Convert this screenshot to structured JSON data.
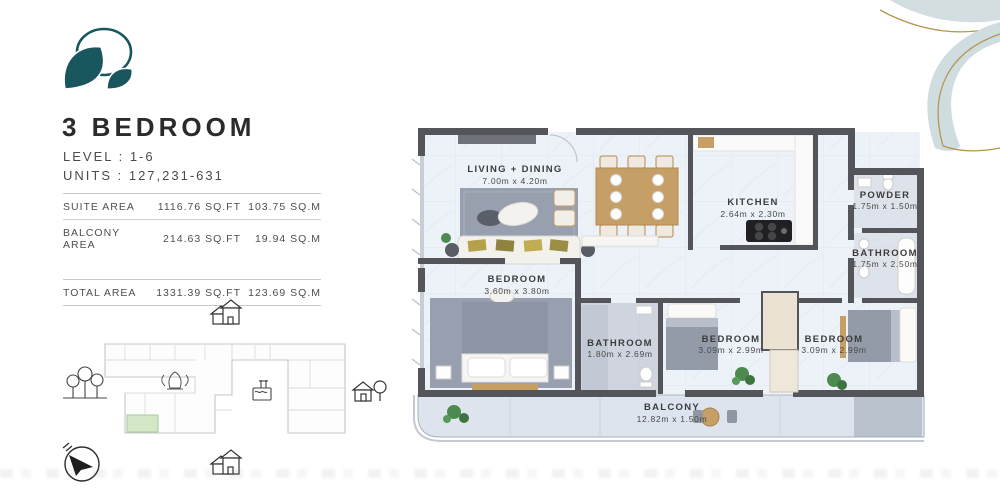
{
  "unit": {
    "title": "3 BEDROOM",
    "level": "LEVEL : 1-6",
    "units": "UNITS : 127,231-631"
  },
  "area_table": {
    "rows": [
      {
        "label": "SUITE AREA",
        "sqft": "1116.76 SQ.FT",
        "sqm": "103.75 SQ.M"
      },
      {
        "label": "BALCONY AREA",
        "sqft": "214.63 SQ.FT",
        "sqm": "19.94 SQ.M"
      },
      {
        "label": "TOTAL AREA",
        "sqft": "1331.39 SQ.FT",
        "sqm": "123.69 SQ.M"
      }
    ]
  },
  "floor_plan": {
    "rooms": {
      "living_dining": {
        "name": "LIVING + DINING",
        "dims": "7.00m x 4.20m"
      },
      "kitchen": {
        "name": "KITCHEN",
        "dims": "2.64m x 2.30m"
      },
      "powder": {
        "name": "POWDER",
        "dims": "1.75m x 1.50m"
      },
      "bathroom_right": {
        "name": "BATHROOM",
        "dims": "1.75m x 2.50m"
      },
      "bedroom_left": {
        "name": "BEDROOM",
        "dims": "3.60m x 3.80m"
      },
      "bathroom_mid": {
        "name": "BATHROOM",
        "dims": "1.80m x 2.69m"
      },
      "bedroom_mid": {
        "name": "BEDROOM",
        "dims": "3.09m x 2.99m"
      },
      "bedroom_right": {
        "name": "BEDROOM",
        "dims": "3.09m x 2.99m"
      },
      "balcony": {
        "name": "BALCONY",
        "dims": "12.82m x 1.50m"
      }
    }
  },
  "site_plan": {
    "icons": {
      "building_footprint": "outline",
      "highlighted_unit": "green-rect",
      "neighbor_houses_north": "two-houses",
      "neighbor_houses_south": "two-houses",
      "trees_west": "three-trees",
      "house_tree_east": "house-and-tree",
      "pool": "pool",
      "garden_plant": "sprout",
      "compass": "north-arrow"
    }
  },
  "colors": {
    "brand_teal": "#1a565e",
    "accent_gold": "#b3954e",
    "decor_leaf": "#cfdce0",
    "wall": "#54555a",
    "floor": "#edf1f8",
    "balcony_floor": "#dde4ee",
    "rug": "#98a0af",
    "wood": "#c69f66",
    "highlight_unit": "#d4e8c8",
    "plant_green": "#4c8a4f"
  }
}
